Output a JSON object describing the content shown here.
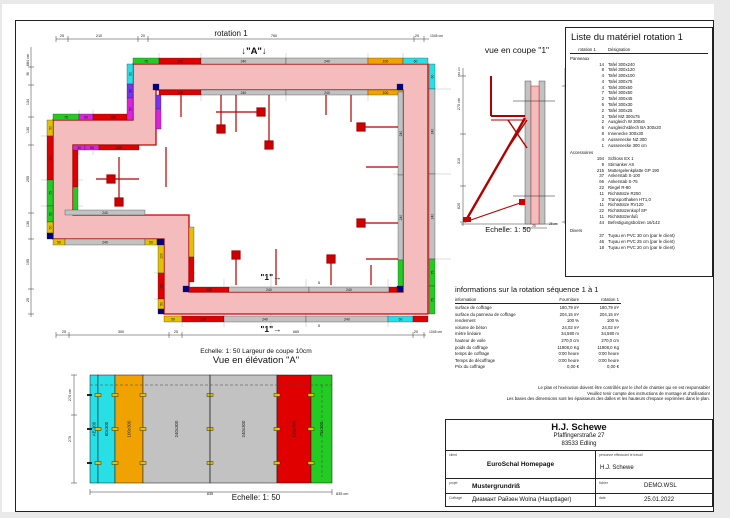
{
  "palette": {
    "green": "#22cc22",
    "red": "#e10000",
    "gray": "#c2c2c2",
    "orange": "#f0a300",
    "cyan": "#29dfe6",
    "magenta": "#dd22dd",
    "purple": "#7733ee",
    "yellow": "#e3c100",
    "navy": "#000088",
    "wall_fill": "#f5bcbe",
    "wall_line": "#cc0000",
    "prop_red": "#b30000"
  },
  "plan": {
    "title": "rotation 1",
    "marker_a": "↓\"A\"↓",
    "marker_1a": "\"1\"→",
    "marker_1b": "\"1\"→",
    "spacer_a": "5",
    "spacer_b": "5",
    "dim_labels": [
      {
        "t": "25",
        "x": 41,
        "y": 10
      },
      {
        "t": "210",
        "x": 78,
        "y": 10
      },
      {
        "t": "20",
        "x": 122,
        "y": 10
      },
      {
        "t": "760",
        "x": 253,
        "y": 10
      },
      {
        "t": "20",
        "x": 396,
        "y": 10
      },
      {
        "t": "1045 cm",
        "x": 409,
        "y": 10,
        "anchor": "start",
        "fs": 3.4
      },
      {
        "t": "684 cm",
        "x": 8,
        "y": 33,
        "rot": 1
      },
      {
        "t": "36",
        "x": 8,
        "y": 47,
        "rot": 1,
        "fs": 3.2
      },
      {
        "t": "134",
        "x": 8,
        "y": 75,
        "rot": 1
      },
      {
        "t": "130",
        "x": 8,
        "y": 103,
        "rot": 1
      },
      {
        "t": "255",
        "x": 8,
        "y": 152,
        "rot": 1
      },
      {
        "t": "130",
        "x": 8,
        "y": 197,
        "rot": 1
      },
      {
        "t": "195",
        "x": 8,
        "y": 235,
        "rot": 1
      },
      {
        "t": "25",
        "x": 8,
        "y": 273,
        "rot": 1
      },
      {
        "t": "25",
        "x": 43,
        "y": 306
      },
      {
        "t": "300",
        "x": 100,
        "y": 306
      },
      {
        "t": "25",
        "x": 155,
        "y": 306
      },
      {
        "t": "665",
        "x": 275,
        "y": 306
      },
      {
        "t": "20",
        "x": 395,
        "y": 306
      },
      {
        "t": "1045 cm",
        "x": 408,
        "y": 306,
        "anchor": "start",
        "fs": 3.4
      }
    ],
    "panels": [
      {
        "x": 112,
        "y": 31,
        "w": 26,
        "h": 6,
        "c": "green",
        "t": "75"
      },
      {
        "x": 138,
        "y": 31,
        "w": 42,
        "h": 6,
        "c": "red",
        "t": "120"
      },
      {
        "x": 180,
        "y": 31,
        "w": 85,
        "h": 6,
        "c": "gray",
        "t": "240"
      },
      {
        "x": 265,
        "y": 31,
        "w": 82,
        "h": 6,
        "c": "gray",
        "t": "240"
      },
      {
        "x": 347,
        "y": 31,
        "w": 35,
        "h": 6,
        "c": "orange",
        "t": "100"
      },
      {
        "x": 382,
        "y": 31,
        "w": 25,
        "h": 6,
        "c": "cyan",
        "t": "60"
      },
      {
        "x": 138,
        "y": 63,
        "w": 42,
        "h": 5,
        "c": "red",
        "t": "120"
      },
      {
        "x": 180,
        "y": 63,
        "w": 85,
        "h": 5,
        "c": "gray",
        "t": "240"
      },
      {
        "x": 265,
        "y": 63,
        "w": 82,
        "h": 5,
        "c": "gray",
        "t": "240"
      },
      {
        "x": 347,
        "y": 63,
        "w": 35,
        "h": 5,
        "c": "orange",
        "t": "100"
      },
      {
        "x": 408,
        "y": 37,
        "w": 6,
        "h": 25,
        "c": "cyan",
        "t": "60",
        "rot": 1
      },
      {
        "x": 408,
        "y": 62,
        "w": 6,
        "h": 85,
        "c": "gray",
        "t": "240",
        "rot": 1
      },
      {
        "x": 408,
        "y": 147,
        "w": 6,
        "h": 85,
        "c": "gray",
        "t": "240",
        "rot": 1
      },
      {
        "x": 408,
        "y": 232,
        "w": 6,
        "h": 27,
        "c": "green",
        "t": "75",
        "rot": 1
      },
      {
        "x": 408,
        "y": 259,
        "w": 6,
        "h": 28,
        "c": "green",
        "t": "75",
        "rot": 1
      },
      {
        "x": 377,
        "y": 65,
        "w": 5,
        "h": 83,
        "c": "gray",
        "t": "240",
        "rot": 1
      },
      {
        "x": 377,
        "y": 148,
        "w": 5,
        "h": 85,
        "c": "gray",
        "t": "240",
        "rot": 1
      },
      {
        "x": 377,
        "y": 233,
        "w": 5,
        "h": 27,
        "c": "green",
        "rot": 1
      },
      {
        "x": 143,
        "y": 289,
        "w": 18,
        "h": 6,
        "c": "yellow",
        "t": "50"
      },
      {
        "x": 161,
        "y": 289,
        "w": 42,
        "h": 6,
        "c": "red",
        "t": "120"
      },
      {
        "x": 203,
        "y": 289,
        "w": 82,
        "h": 6,
        "c": "gray",
        "t": "240"
      },
      {
        "x": 285,
        "y": 289,
        "w": 82,
        "h": 6,
        "c": "gray",
        "t": "240"
      },
      {
        "x": 367,
        "y": 289,
        "w": 25,
        "h": 6,
        "c": "cyan",
        "t": "60"
      },
      {
        "x": 392,
        "y": 289,
        "w": 15,
        "h": 6,
        "c": "red"
      },
      {
        "x": 168,
        "y": 260,
        "w": 40,
        "h": 5,
        "c": "red",
        "t": "120"
      },
      {
        "x": 208,
        "y": 260,
        "w": 80,
        "h": 5,
        "c": "gray",
        "t": "240"
      },
      {
        "x": 288,
        "y": 260,
        "w": 80,
        "h": 5,
        "c": "gray",
        "t": "240"
      },
      {
        "x": 368,
        "y": 260,
        "w": 14,
        "h": 5,
        "c": "red"
      },
      {
        "x": 26,
        "y": 93,
        "w": 6,
        "h": 16,
        "c": "yellow",
        "t": "50",
        "rot": 1
      },
      {
        "x": 26,
        "y": 109,
        "w": 6,
        "h": 44,
        "c": "red",
        "t": "120",
        "rot": 1
      },
      {
        "x": 26,
        "y": 153,
        "w": 6,
        "h": 26,
        "c": "green",
        "t": "75",
        "rot": 1
      },
      {
        "x": 26,
        "y": 179,
        "w": 6,
        "h": 16,
        "c": "green",
        "t": "50",
        "rot": 1
      },
      {
        "x": 26,
        "y": 195,
        "w": 6,
        "h": 11,
        "c": "yellow",
        "t": "50",
        "rot": 1
      },
      {
        "x": 26,
        "y": 206,
        "w": 6,
        "h": 6,
        "c": "navy"
      },
      {
        "x": 52,
        "y": 118,
        "w": 5,
        "h": 42,
        "c": "red",
        "rot": 1
      },
      {
        "x": 52,
        "y": 160,
        "w": 5,
        "h": 28,
        "c": "green",
        "rot": 1
      },
      {
        "x": 32,
        "y": 87,
        "w": 26,
        "h": 6,
        "c": "green",
        "t": "75"
      },
      {
        "x": 58,
        "y": 87,
        "w": 14,
        "h": 6,
        "c": "magenta",
        "t": "50"
      },
      {
        "x": 72,
        "y": 87,
        "w": 40,
        "h": 6,
        "c": "red",
        "t": "120"
      },
      {
        "x": 52,
        "y": 118,
        "w": 12,
        "h": 5,
        "c": "magenta",
        "t": "30"
      },
      {
        "x": 64,
        "y": 118,
        "w": 14,
        "h": 5,
        "c": "magenta",
        "t": "50"
      },
      {
        "x": 78,
        "y": 118,
        "w": 40,
        "h": 5,
        "c": "red",
        "t": "120"
      },
      {
        "x": 106,
        "y": 37,
        "w": 6,
        "h": 20,
        "c": "cyan",
        "t": "50",
        "rot": 1
      },
      {
        "x": 106,
        "y": 57,
        "w": 6,
        "h": 14,
        "c": "purple",
        "t": "30",
        "rot": 1
      },
      {
        "x": 106,
        "y": 71,
        "w": 6,
        "h": 22,
        "c": "magenta",
        "t": "50",
        "rot": 1
      },
      {
        "x": 135,
        "y": 68,
        "w": 5,
        "h": 14,
        "c": "purple",
        "rot": 1
      },
      {
        "x": 135,
        "y": 82,
        "w": 5,
        "h": 20,
        "c": "magenta",
        "rot": 1
      },
      {
        "x": 137,
        "y": 212,
        "w": 6,
        "h": 34,
        "c": "yellow",
        "t": "100",
        "rot": 1
      },
      {
        "x": 137,
        "y": 246,
        "w": 6,
        "h": 26,
        "c": "red",
        "t": "120",
        "rot": 1
      },
      {
        "x": 137,
        "y": 272,
        "w": 6,
        "h": 10,
        "c": "yellow",
        "t": "50",
        "rot": 1
      },
      {
        "x": 137,
        "y": 282,
        "w": 6,
        "h": 5,
        "c": "navy"
      },
      {
        "x": 168,
        "y": 200,
        "w": 5,
        "h": 30,
        "c": "yellow",
        "rot": 1
      },
      {
        "x": 168,
        "y": 230,
        "w": 5,
        "h": 25,
        "c": "red",
        "rot": 1
      },
      {
        "x": 32,
        "y": 212,
        "w": 12,
        "h": 6,
        "c": "yellow",
        "t": "50"
      },
      {
        "x": 44,
        "y": 212,
        "w": 80,
        "h": 6,
        "c": "gray",
        "t": "240"
      },
      {
        "x": 124,
        "y": 212,
        "w": 12,
        "h": 6,
        "c": "yellow",
        "t": "50"
      },
      {
        "x": 136,
        "y": 212,
        "w": 7,
        "h": 6,
        "c": "navy"
      },
      {
        "x": 44,
        "y": 183,
        "w": 80,
        "h": 5,
        "c": "gray",
        "t": "240"
      },
      {
        "x": 132,
        "y": 57,
        "w": 6,
        "h": 6,
        "c": "navy"
      },
      {
        "x": 376,
        "y": 57,
        "w": 6,
        "h": 6,
        "c": "navy"
      },
      {
        "x": 376,
        "y": 259,
        "w": 6,
        "h": 6,
        "c": "navy"
      },
      {
        "x": 162,
        "y": 259,
        "w": 6,
        "h": 6,
        "c": "navy"
      }
    ]
  },
  "coupe": {
    "title": "vue en coupe \"1\"",
    "scale": "Echelle: 1: 50",
    "dim_labels": [
      {
        "t": "684 cm",
        "x": 7,
        "y": 16,
        "rot": 1,
        "fs": 3
      },
      {
        "t": "270 cm",
        "x": 7,
        "y": 48,
        "rot": 1
      },
      {
        "t": "310",
        "x": 7,
        "y": 105,
        "rot": 1
      },
      {
        "t": "620",
        "x": 7,
        "y": 150,
        "rot": 1
      },
      {
        "t": "300 cm",
        "x": 117,
        "y": 22,
        "rot": 1
      },
      {
        "t": "300",
        "x": 117,
        "y": 100,
        "rot": 1
      },
      {
        "t": "25",
        "x": 81,
        "y": 171,
        "fs": 3.2
      },
      {
        "t": "25 cm",
        "x": 96,
        "y": 169,
        "fs": 3.2,
        "anchor": "start"
      }
    ]
  },
  "materials": {
    "title": "Liste du matériel  rotation 1",
    "col1": "rotation 1",
    "col2": "Désignation",
    "groups": [
      {
        "name": "Panneaux",
        "items": [
          [
            "14",
            "Tafel 300x240"
          ],
          [
            "8",
            "Tafel 300x120"
          ],
          [
            "4",
            "Tafel 300x100"
          ],
          [
            "4",
            "Tafel 300x75"
          ],
          [
            "4",
            "Tafel 300x60"
          ],
          [
            "7",
            "Tafel 300x50"
          ],
          [
            "2",
            "Tafel 300x45"
          ],
          [
            "6",
            "Tafel 300x30"
          ],
          [
            "2",
            "Tafel 300x25"
          ],
          [
            "3",
            "Tafel MZ 300x75"
          ],
          [
            "2",
            "Ausgleich W 300x5"
          ],
          [
            "6",
            "Ausgleichsblech BA 300x20"
          ],
          [
            "8",
            "Innenecke 300x30"
          ],
          [
            "4",
            "Aussenecke NZ 300"
          ],
          [
            "1",
            "Aussenecke 300 cm"
          ]
        ]
      },
      {
        "name": "Accessoires",
        "items": [
          [
            "194",
            "Schloss EX 1"
          ],
          [
            "9",
            "Stirnanker AS"
          ],
          [
            "215",
            "Muttergelenkplatte GP 190"
          ],
          [
            "37",
            "Ankerstab S-100"
          ],
          [
            "66",
            "Ankerstab S-75"
          ],
          [
            "22",
            "Riegel R-80"
          ],
          [
            "11",
            "Richtstütze R250"
          ],
          [
            "2",
            "Transporthaken HT1,0"
          ],
          [
            "11",
            "Richtstütze RV120"
          ],
          [
            "22",
            "Richtstützenkopf SP"
          ],
          [
            "11",
            "Richtstützenfuß"
          ],
          [
            "44",
            "Befestigungsbolzen 16/142"
          ]
        ]
      },
      {
        "name": "Divers",
        "items": [
          [
            "37",
            "Tuyau en PVC 30 cm (par le client)"
          ],
          [
            "46",
            "Tuyau en PVC 25 cm (par le client)"
          ],
          [
            "18",
            "Tuyau en PVC 20 cm (par le client)"
          ]
        ]
      }
    ]
  },
  "info": {
    "title": "informations sur la rotation  séquence 1 à 1",
    "headers": [
      "information",
      "Fourniture",
      "rotation 1"
    ],
    "rows": [
      [
        "surface de coffrage",
        "180,79 m²",
        "180,79 m²"
      ],
      [
        "surface du panneau de coffrage",
        "204,15 m²",
        "204,15 m²"
      ],
      [
        "rendement",
        "100 %",
        "100 %"
      ],
      [
        "volume de béton",
        "24,02 m³",
        "24,02 m³"
      ],
      [
        "mètre linéaire",
        "34,580 m",
        "34,580 m"
      ],
      [
        "hauteur de voile",
        "270,0 cm",
        "270,0 cm"
      ],
      [
        "poids du coffrage",
        "11908,0 Kg",
        "11908,0 Kg"
      ],
      [
        "temps de coffrage",
        "0:00 heure",
        "0:00 heure"
      ],
      [
        "Temps de décoffrage",
        "0:00 heure",
        "0:00 heure"
      ],
      [
        "Prix du coffrage",
        "0,00 €",
        "0,00 €"
      ]
    ]
  },
  "notes": [
    "Le plan et l'exécution doivent être contrôlés par le chef de chantier qui en est responsable!",
    "Veuillez tenir compte des instructions de montage et d'utilisation!",
    "Les bases des dimensions sont les épaisseurs des dalles et les hauteurs d'espace exprimées dans le plan."
  ],
  "elevation": {
    "pre_title": "Echelle: 1: 50   Largeur de coupe 10cm",
    "title": "Vue en élévation \"A\"",
    "scale": "Echelle: 1: 50",
    "panels": [
      {
        "x": 30,
        "w": 8,
        "c": "cyan",
        "label": "AE 300"
      },
      {
        "x": 38,
        "w": 17,
        "c": "cyan",
        "label": "60x300"
      },
      {
        "x": 55,
        "w": 28,
        "c": "orange",
        "label": "100x300"
      },
      {
        "x": 83,
        "w": 67,
        "c": "gray",
        "label": "240x300"
      },
      {
        "x": 150,
        "w": 67,
        "c": "gray",
        "label": "240x300"
      },
      {
        "x": 217,
        "w": 34,
        "c": "red",
        "label": "120x300"
      },
      {
        "x": 251,
        "w": 21,
        "c": "green",
        "label": "75x300"
      }
    ],
    "dim_labels": [
      {
        "t": "270 cm",
        "x": 11,
        "y": 28,
        "rot": 1
      },
      {
        "t": "270",
        "x": 11,
        "y": 72,
        "rot": 1
      },
      {
        "t": "835",
        "x": 150,
        "y": 128
      },
      {
        "t": "835 cm",
        "x": 276,
        "y": 128,
        "anchor": "start"
      }
    ]
  },
  "titleblock": {
    "company": "H.J. Schewe",
    "address1": "Pfaffingerstraße 27",
    "address2": "83533 Edling",
    "client_label": "client",
    "client_value": "EuroSchal Homepage",
    "person_label": "personne effectuant le travail",
    "person_value": "H.J. Schewe",
    "project_label": "projet",
    "project_value": "Mustergrundriß",
    "file_label": "fichier",
    "file_value": "DEMO.WSL",
    "coffrage_label": "Coffrage",
    "coffrage_value": "Диамант Райзен Wolna (Hauptlager)",
    "date_label": "date",
    "date_value": "25.01.2022"
  }
}
